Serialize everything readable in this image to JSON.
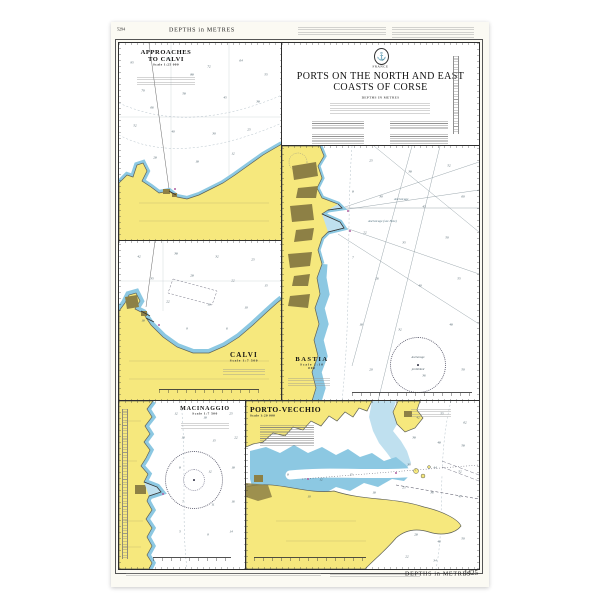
{
  "colors": {
    "paper": "#fbfaf3",
    "land": "#f6e87d",
    "shallow": "#8cc8e2",
    "shallow_light": "#bfe0ef",
    "urban": "#8d8045",
    "coast": "#5f6257",
    "sea_line": "#7d8c94",
    "magenta": "#b05fa0"
  },
  "margins": {
    "top_left_code": "5294",
    "top_depths": "DEPTHS in METRES",
    "bottom_depths": "DEPTHS in METRES",
    "chart_number": "1425"
  },
  "title_block": {
    "country": "FRANCE",
    "title1": "PORTS ON THE NORTH AND EAST",
    "title2": "COASTS OF CORSE",
    "subtitle": "DEPTHS IN METRES",
    "anchor_glyph": "⚓"
  },
  "panels": {
    "approaches": {
      "title1": "APPROACHES",
      "title2": "TO CALVI",
      "scale": "Scale 1:25 000",
      "soundings": [
        {
          "x": 8,
          "y": 10,
          "v": "95"
        },
        {
          "x": 30,
          "y": 8,
          "v": "80"
        },
        {
          "x": 55,
          "y": 12,
          "v": "72"
        },
        {
          "x": 75,
          "y": 9,
          "v": "64"
        },
        {
          "x": 90,
          "y": 16,
          "v": "55"
        },
        {
          "x": 15,
          "y": 24,
          "v": "70"
        },
        {
          "x": 40,
          "y": 26,
          "v": "58"
        },
        {
          "x": 65,
          "y": 28,
          "v": "45"
        },
        {
          "x": 85,
          "y": 30,
          "v": "38"
        },
        {
          "x": 10,
          "y": 42,
          "v": "52"
        },
        {
          "x": 33,
          "y": 45,
          "v": "40"
        },
        {
          "x": 58,
          "y": 46,
          "v": "30"
        },
        {
          "x": 80,
          "y": 44,
          "v": "25"
        },
        {
          "x": 22,
          "y": 58,
          "v": "28"
        },
        {
          "x": 48,
          "y": 60,
          "v": "18"
        },
        {
          "x": 70,
          "y": 56,
          "v": "12"
        },
        {
          "x": 45,
          "y": 16,
          "v": "88"
        },
        {
          "x": 20,
          "y": 33,
          "v": "66"
        }
      ]
    },
    "calvi": {
      "title": "CALVI",
      "scale": "Scale 1:7 500",
      "soundings": [
        {
          "x": 12,
          "y": 10,
          "v": "42"
        },
        {
          "x": 35,
          "y": 8,
          "v": "38"
        },
        {
          "x": 60,
          "y": 10,
          "v": "32"
        },
        {
          "x": 82,
          "y": 12,
          "v": "25"
        },
        {
          "x": 20,
          "y": 24,
          "v": "35"
        },
        {
          "x": 45,
          "y": 22,
          "v": "28"
        },
        {
          "x": 70,
          "y": 25,
          "v": "22"
        },
        {
          "x": 90,
          "y": 28,
          "v": "15"
        },
        {
          "x": 30,
          "y": 38,
          "v": "22"
        },
        {
          "x": 55,
          "y": 40,
          "v": "16"
        },
        {
          "x": 78,
          "y": 42,
          "v": "10"
        },
        {
          "x": 15,
          "y": 50,
          "v": "18"
        },
        {
          "x": 42,
          "y": 55,
          "v": "9"
        },
        {
          "x": 66,
          "y": 55,
          "v": "6"
        }
      ]
    },
    "bastia": {
      "title": "BASTIA",
      "scale": "Scale 1:10 000",
      "anchorage": "Anchorage",
      "anchorage2": "Anchorage (see Note)",
      "prohib1": "Anchorage",
      "prohib2": "prohibited",
      "soundings": [
        {
          "x": 45,
          "y": 6,
          "v": "25"
        },
        {
          "x": 65,
          "y": 10,
          "v": "38"
        },
        {
          "x": 85,
          "y": 8,
          "v": "52"
        },
        {
          "x": 50,
          "y": 20,
          "v": "30"
        },
        {
          "x": 72,
          "y": 24,
          "v": "45"
        },
        {
          "x": 92,
          "y": 20,
          "v": "60"
        },
        {
          "x": 42,
          "y": 34,
          "v": "22"
        },
        {
          "x": 62,
          "y": 38,
          "v": "35"
        },
        {
          "x": 84,
          "y": 36,
          "v": "50"
        },
        {
          "x": 48,
          "y": 52,
          "v": "26"
        },
        {
          "x": 70,
          "y": 55,
          "v": "40"
        },
        {
          "x": 90,
          "y": 52,
          "v": "55"
        },
        {
          "x": 40,
          "y": 70,
          "v": "18"
        },
        {
          "x": 60,
          "y": 72,
          "v": "32"
        },
        {
          "x": 86,
          "y": 70,
          "v": "48"
        },
        {
          "x": 45,
          "y": 88,
          "v": "20"
        },
        {
          "x": 72,
          "y": 90,
          "v": "36"
        },
        {
          "x": 92,
          "y": 88,
          "v": "50"
        },
        {
          "x": 36,
          "y": 18,
          "v": "8"
        },
        {
          "x": 36,
          "y": 44,
          "v": "7"
        }
      ]
    },
    "macinaggio": {
      "title": "MACINAGGIO",
      "scale": "Scale 1:7 500",
      "soundings": [
        {
          "x": 45,
          "y": 8,
          "v": "12"
        },
        {
          "x": 68,
          "y": 10,
          "v": "18"
        },
        {
          "x": 88,
          "y": 8,
          "v": "25"
        },
        {
          "x": 50,
          "y": 22,
          "v": "10"
        },
        {
          "x": 75,
          "y": 24,
          "v": "15"
        },
        {
          "x": 92,
          "y": 22,
          "v": "22"
        },
        {
          "x": 48,
          "y": 40,
          "v": "8"
        },
        {
          "x": 72,
          "y": 42,
          "v": "12"
        },
        {
          "x": 90,
          "y": 40,
          "v": "18"
        },
        {
          "x": 50,
          "y": 60,
          "v": "7"
        },
        {
          "x": 74,
          "y": 62,
          "v": "11"
        },
        {
          "x": 90,
          "y": 60,
          "v": "16"
        },
        {
          "x": 48,
          "y": 78,
          "v": "5"
        },
        {
          "x": 70,
          "y": 80,
          "v": "9"
        },
        {
          "x": 88,
          "y": 78,
          "v": "14"
        }
      ]
    },
    "porto": {
      "title": "PORTO-VECCHIO",
      "scale": "Scale 1:20 000",
      "soundings": [
        {
          "x": 74,
          "y": 10,
          "v": "42"
        },
        {
          "x": 84,
          "y": 8,
          "v": "55"
        },
        {
          "x": 94,
          "y": 13,
          "v": "62"
        },
        {
          "x": 72,
          "y": 22,
          "v": "38"
        },
        {
          "x": 83,
          "y": 25,
          "v": "48"
        },
        {
          "x": 93,
          "y": 27,
          "v": "58"
        },
        {
          "x": 70,
          "y": 38,
          "v": "30"
        },
        {
          "x": 81,
          "y": 40,
          "v": "44"
        },
        {
          "x": 92,
          "y": 42,
          "v": "52"
        },
        {
          "x": 68,
          "y": 52,
          "v": "25"
        },
        {
          "x": 80,
          "y": 55,
          "v": "36"
        },
        {
          "x": 92,
          "y": 57,
          "v": "47"
        },
        {
          "x": 73,
          "y": 80,
          "v": "28"
        },
        {
          "x": 83,
          "y": 84,
          "v": "40"
        },
        {
          "x": 93,
          "y": 82,
          "v": "50"
        },
        {
          "x": 69,
          "y": 93,
          "v": "22"
        },
        {
          "x": 81,
          "y": 95,
          "v": "34"
        },
        {
          "x": 18,
          "y": 44,
          "v": "8"
        },
        {
          "x": 32,
          "y": 47,
          "v": "12"
        },
        {
          "x": 27,
          "y": 57,
          "v": "10"
        },
        {
          "x": 45,
          "y": 44,
          "v": "15"
        },
        {
          "x": 55,
          "y": 55,
          "v": "18"
        }
      ]
    }
  }
}
